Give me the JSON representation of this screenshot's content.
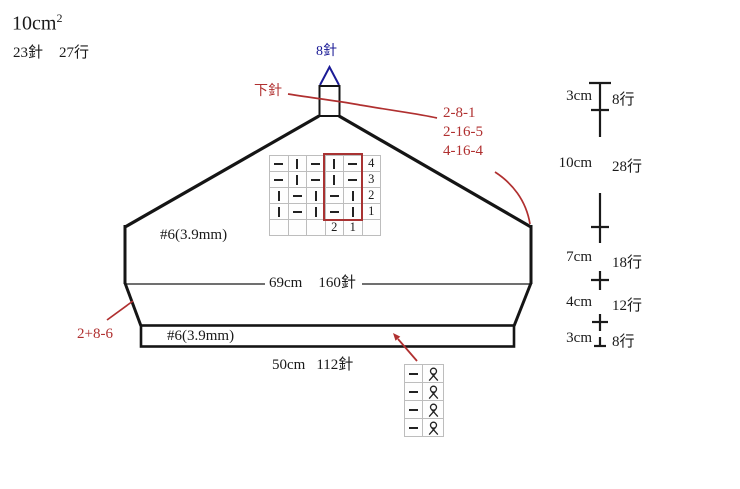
{
  "gauge": {
    "size": "10cm",
    "exponent": "2",
    "stitches": "23針",
    "rows": "27行"
  },
  "top": {
    "crown_stitches": "8針",
    "stitch_label": "下針",
    "decrease_notes": [
      "2-8-1",
      "2-16-5",
      "4-16-4"
    ]
  },
  "body": {
    "needle_label": "#6(3.9mm)",
    "width": "69cm",
    "width_stitches": "160針"
  },
  "band": {
    "needle_label": "#6(3.9mm)",
    "width": "50cm",
    "width_stitches": "112針",
    "left_note": "2+8-6"
  },
  "main_chart": {
    "rows": [
      {
        "number": "4",
        "cells": [
          "purl",
          "knit",
          "purl",
          "knit",
          "purl"
        ]
      },
      {
        "number": "3",
        "cells": [
          "purl",
          "knit",
          "purl",
          "knit",
          "purl"
        ]
      },
      {
        "number": "2",
        "cells": [
          "knit",
          "purl",
          "knit",
          "purl",
          "knit"
        ]
      },
      {
        "number": "1",
        "cells": [
          "knit",
          "purl",
          "knit",
          "purl",
          "knit"
        ]
      }
    ],
    "column_numbers": [
      "",
      "",
      "",
      "2",
      "1"
    ],
    "highlight_columns": "1-2 (repeat box)"
  },
  "small_chart": {
    "rows": [
      [
        "purl",
        "twist"
      ],
      [
        "purl",
        "twist"
      ],
      [
        "purl",
        "twist"
      ],
      [
        "purl",
        "twist"
      ]
    ]
  },
  "right_ruler": {
    "segments": [
      {
        "length": "3cm",
        "rows": "8行"
      },
      {
        "length": "10cm",
        "rows": "28行"
      },
      {
        "length": "7cm",
        "rows": "18行"
      },
      {
        "length": "4cm",
        "rows": "12行"
      },
      {
        "length": "3cm",
        "rows": "8行"
      }
    ]
  },
  "colors": {
    "annotation_red": "#b03030",
    "navy_blue": "#1b1b96",
    "outline_black": "#151515",
    "grid_gray": "#bdbdbd"
  }
}
